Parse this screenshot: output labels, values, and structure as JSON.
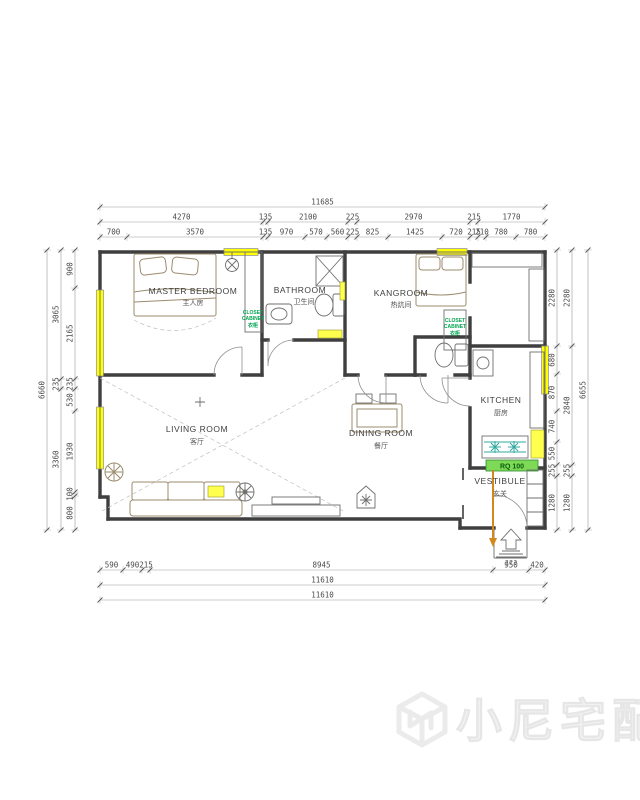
{
  "dims": {
    "top": {
      "row1": [
        "11685"
      ],
      "row2": [
        "4270",
        "135",
        "2100",
        "225",
        "2970",
        "215",
        "1770"
      ],
      "row3": [
        "700",
        "3570",
        "135",
        "970",
        "570",
        "560",
        "225",
        "825",
        "1425",
        "720",
        "215",
        "210",
        "780",
        "780"
      ]
    },
    "bottom": {
      "row1": [
        "590",
        "490",
        "215",
        "8945",
        "950",
        "420"
      ],
      "row2": [
        "11610"
      ],
      "row3": [
        "11610"
      ]
    },
    "left": {
      "outer": [
        "6660"
      ],
      "mid": [
        "3065",
        "235",
        "3360"
      ],
      "inner": [
        "900",
        "2165",
        "235",
        "530",
        "1930",
        "100",
        "800"
      ]
    },
    "right": {
      "inner": [
        "2280",
        "680",
        "870",
        "740",
        "550",
        "255",
        "1280"
      ],
      "mid": [
        "2280",
        "2840",
        "255",
        "1280"
      ],
      "outer": [
        "6655"
      ]
    }
  },
  "rooms": {
    "master_bedroom": {
      "en": "MASTER BEDROOM",
      "cn": "主人房"
    },
    "bathroom": {
      "en": "BATHROOM",
      "cn": "卫生间"
    },
    "kangroom": {
      "en": "KANGROOM",
      "cn": "热炕间"
    },
    "living_room": {
      "en": "LIVING ROOM",
      "cn": "客厅"
    },
    "dining_room": {
      "en": "DINING ROOM",
      "cn": "餐厅"
    },
    "kitchen": {
      "en": "KITCHEN",
      "cn": "厨房"
    },
    "vestibule": {
      "en": "VESTIBULE",
      "cn": "玄关"
    }
  },
  "annotations": {
    "closet_left": {
      "line1": "CLOSET",
      "line2": "CABINET",
      "line3": "衣柜"
    },
    "closet_right": {
      "line1": "CLOSET",
      "line2": "CABINET",
      "line3": "衣柜"
    },
    "gas_meter": "RQ 100",
    "entry_text": "???"
  },
  "watermark": {
    "text": "小尼宅配"
  },
  "colors": {
    "window_yellow": "#FFFF00",
    "cabinet_green": "#00A651",
    "meter_green": "#7ED957",
    "door_orange": "#D4881C",
    "wall_gray": "#3F3F3F"
  }
}
